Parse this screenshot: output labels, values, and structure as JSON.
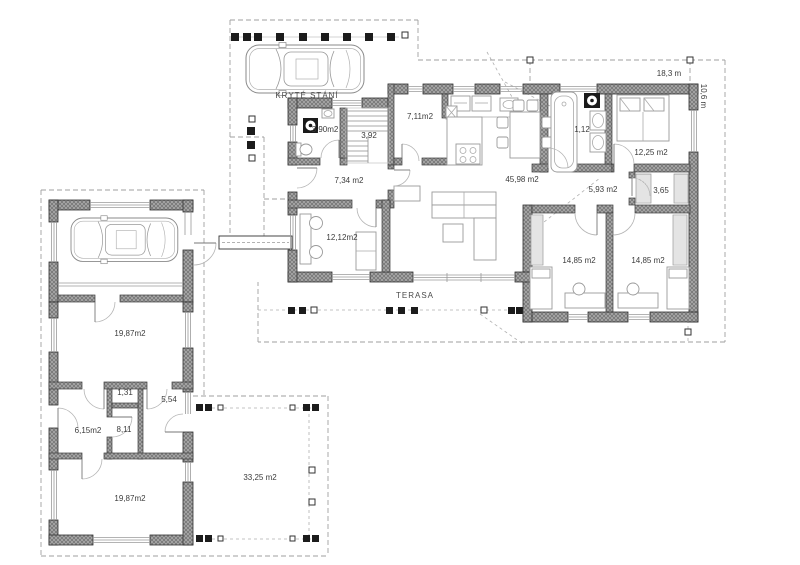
{
  "plan": {
    "carport_label": "KRYTÉ STÁNÍ",
    "terrace_label": "TERASA",
    "dimensions": {
      "width": "18,3 m",
      "depth": "10,6 m"
    },
    "main_house": {
      "utility_wc": "3,90m2",
      "staircase": "3,92",
      "pantry": "7,11m2",
      "entry_hall": "7,34 m2",
      "living_kitchen": "45,98 m2",
      "bathroom": "1,12",
      "bedroom_master": "12,25 m2",
      "hallway": "5,93 m2",
      "closet": "3,65",
      "study": "12,12m2",
      "bedroom_left": "14,85 m2",
      "bedroom_right": "14,85 m2"
    },
    "annex": {
      "hall_upper": "19,87m2",
      "closet_small": "1,31",
      "vestibule": "5,54",
      "bathroom_small": "6,15m2",
      "room_small": "8,11",
      "hall_lower": "19,87m2"
    },
    "terrace_south": "33,25 m2"
  }
}
